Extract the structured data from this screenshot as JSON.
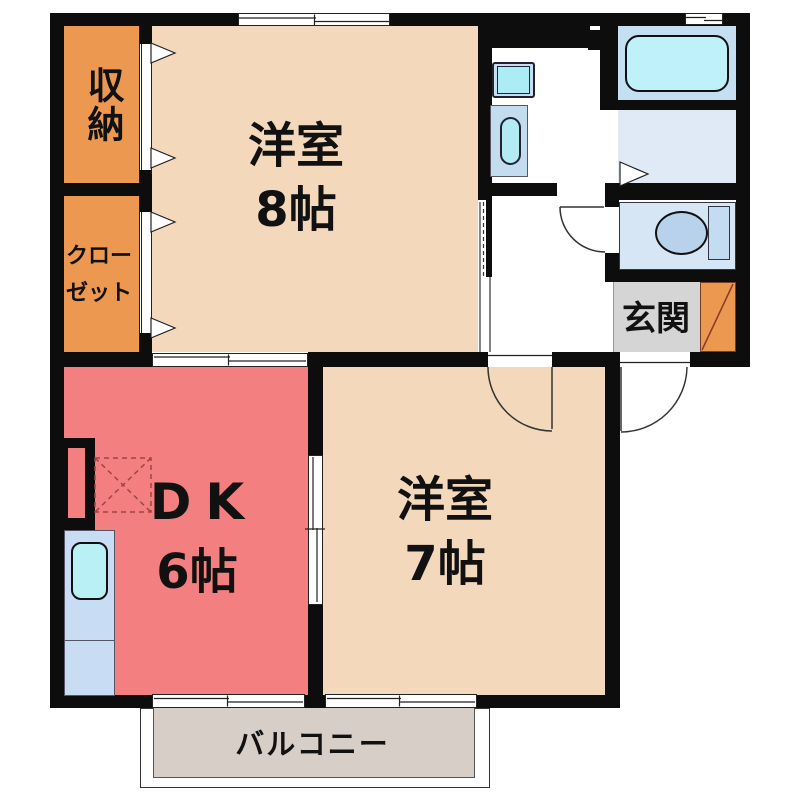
{
  "plan_title": "2DK apartment floor plan",
  "rooms": {
    "western8": {
      "name": "洋室",
      "size": "8帖",
      "color": "#F3D8BB"
    },
    "western7": {
      "name": "洋室",
      "size": "7帖",
      "color": "#F3D8BB"
    },
    "dk": {
      "name": "DK",
      "size": "6帖",
      "color": "#F47F80"
    },
    "storage": {
      "name": "収納",
      "color": "#EC9851"
    },
    "closet": {
      "name": "クローゼット",
      "line1": "クロー",
      "line2": "ゼット",
      "color": "#EC9851"
    },
    "genkan": {
      "name": "玄関",
      "color": "#D5D5D5"
    },
    "balcony": {
      "name": "バルコニー",
      "color": "#D7CEC7"
    },
    "bathroom": {
      "color": "#C4DEF2"
    },
    "dressing_room": {
      "color": "#DFEAF6"
    },
    "toilet": {
      "color": "#D7E6F4"
    }
  },
  "colors": {
    "wall": "#0d0d0d",
    "room_beige": "#F3D8BB",
    "room_pink": "#F47F80",
    "room_orange": "#EC9851",
    "bath_bg": "#C4DEF2",
    "dressing_bg": "#DFEAF6",
    "toilet_bg": "#D7E6F4",
    "genkan_gray": "#D5D5D5",
    "balcony_fill": "#D7CEC7",
    "counter_blue": "#C8DDF3",
    "fixture_cyan": "#B3EBF5",
    "tub_cyan": "#BFF1FA",
    "fridge_dash": "#A04444"
  }
}
